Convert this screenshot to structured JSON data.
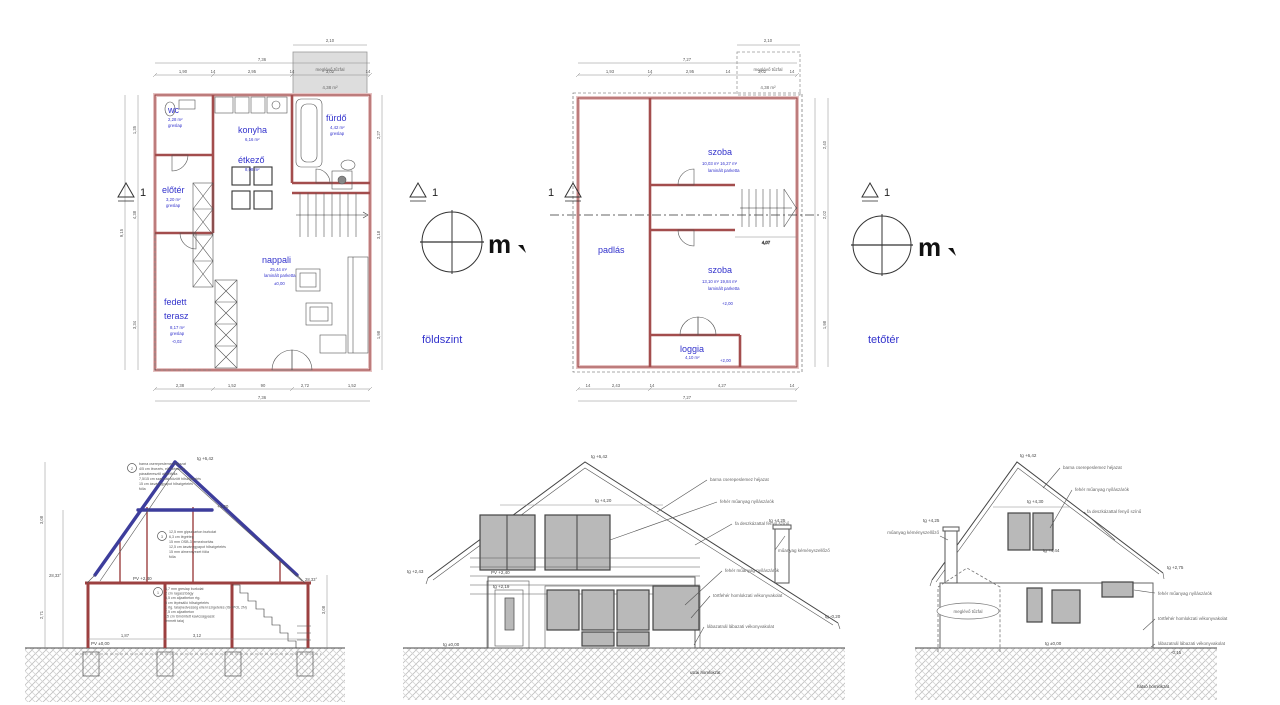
{
  "palette": {
    "wall_edge": "#9c4343",
    "wall_fill": "#e6c2c2",
    "label_blue": "#3232cc",
    "roof_blue": "#3d3d9c",
    "window_gray": "#b9b9b9",
    "ground_hatch": "#bfbfbf"
  },
  "gf": {
    "caption": "földszint",
    "marker": "1",
    "north": "m",
    "shed_label": "meglévő tűzfal",
    "shed_area": "4,38 m²",
    "shed_dim": "2,10",
    "rooms": {
      "wc": {
        "n": "wc",
        "a": "2,28 m²",
        "f": "greslap"
      },
      "konyha": {
        "n": "konyha",
        "a": "6,16 m²"
      },
      "etkezo": {
        "n": "étkező",
        "a": "8,08 m²"
      },
      "furdo": {
        "n": "fürdő",
        "a": "4,42 m²",
        "f": "greslap"
      },
      "eloter": {
        "n": "előtér",
        "a": "3,20 m²",
        "f": "greslap"
      },
      "nappali": {
        "n": "nappali",
        "a": "25,44 m²",
        "f": "laminált parketta",
        "lv": "±0,00"
      },
      "terasz": {
        "n": "fedett",
        "n2": "terasz",
        "a": "8,17 m²",
        "f": "greslap",
        "lv": "-0,02"
      }
    },
    "dim_top": [
      "1,90",
      "14",
      "2,95",
      "14",
      "3,02",
      "14"
    ],
    "dim_top_total": "7,36",
    "dim_bottom": [
      "2,38",
      "1,52",
      "90",
      "2,72",
      "1,52"
    ],
    "dim_bottom_total": "7,36",
    "dim_left": [
      "1,35",
      "4,38",
      "3,34"
    ],
    "dim_left_total": "9,15",
    "dim_right": [
      "2,27",
      "3,18",
      "1,98"
    ]
  },
  "at": {
    "caption": "tetőtér",
    "marker": "1",
    "north": "m",
    "shed_label": "meglévő tűzfal",
    "shed_area": "4,38 m²",
    "shed_dim": "2,10",
    "rooms": {
      "padlas": {
        "n": "padlás"
      },
      "szoba1": {
        "n": "szoba",
        "a": "10,03 m²   16,27 m²",
        "f": "laminált parketta"
      },
      "szoba2": {
        "n": "szoba",
        "a": "13,10 m²   19,84 m²",
        "f": "laminált parketta",
        "lv": "+2,00"
      },
      "loggia": {
        "n": "loggia",
        "a": "4,10 m²",
        "f": "greslap",
        "lv": "+2,00"
      }
    },
    "dim_top": [
      "1,93",
      "14",
      "2,95",
      "14",
      "3,02",
      "14"
    ],
    "dim_top_total": "7,27",
    "dim_bottom": [
      "14",
      "2,43",
      "14",
      "4,27",
      "14"
    ],
    "dim_bottom_total": "7,27",
    "dim_right": [
      "2,40",
      "2,02",
      "1,98"
    ],
    "stair_dim": "4,07"
  },
  "sec": {
    "peak": "tg +6,42",
    "angle_l": "28,33°",
    "angle_r": "28,33°",
    "lv_collar": "+4,20",
    "lv_attic": "PV +2,40",
    "lv_ground": "PV ±0,00",
    "n2_no": "2",
    "n3_no": "3",
    "n1_no": "1",
    "n2": [
      "barna cserepeslemez héjazat",
      "4/5 cm lécezés, ellenlécezés",
      "páraáteresztő alátétfólia",
      "7,5/15 cm szarufák között hőszigetelés",
      "15 cm ásványgyapot hőszigetelés",
      "fólia"
    ],
    "n3": [
      "12,5 mm gipszkarton burkolat",
      "6,3 cm légréteg",
      "15 mm OSB-3 lemezborítás",
      "12,5 cm ásványgyapot hőszigetelés",
      "15 mm álmennyezet fólia",
      "fólia"
    ],
    "n1": [
      "8,7 mm greslap burkolat",
      "2 cm ragasztóágy",
      "6,5 cm aljzatbeton rtg.",
      "5 cm lépésálló hőszigetelés",
      "1 rtg. talajnedvesség elleni szigetelés (ISOPOL 2N)",
      "7,5 cm aljzatbeton",
      "15 cm tömörített kavicságyazat",
      "termett talaj"
    ],
    "dim_left_up": "3,08",
    "dim_left_dn": "2,71",
    "dim_right": "3,08",
    "dim_b1": "1,87",
    "dim_b2": "3,12"
  },
  "fe": {
    "peak": "tg +6,42",
    "lv_gable": "tg +4,20",
    "lv_chimney": "tg +4,25",
    "lv_eave": "tg +2,43",
    "lv_balc": "PV +2,40",
    "lv_door": "tg +2,19",
    "lv_ground": "tg ±0,00",
    "lv_right": "tg -0,20",
    "labels": [
      "barna cserepeslemez héjazat",
      "fehér műanyag nyílászárók",
      "fa deszkázattal fenyő színű",
      "műanyag kéményszellőző",
      "fehér műanyag nyílászárók",
      "törtfehér homlokzati vékonyvakolat",
      "lábazatnál lábazati vékonyvakolat"
    ],
    "caption": "utcai homlokzat"
  },
  "se": {
    "peak": "tg +6,42",
    "lv_gable": "tg +4,30",
    "lv_chimney": "tg +4,25",
    "lv_mid": "tg +4,44",
    "lv_eave_r": "tg +2,75",
    "lv_ground": "tg ±0,00",
    "lv_base": "-0,15",
    "label_l": "műanyag kéményszellőző",
    "labels": [
      "barna cserepeslemez héjazat",
      "fehér műanyag nyílászárók",
      "fa deszkázattal fenyő színű",
      "fehér műanyag nyílászárók",
      "törtfehér homlokzati vékonyvakolat",
      "lábazatnál lábazati vékonyvakolat"
    ],
    "shed": "meglévő tűzfal",
    "caption": "hátsó homlokzat"
  }
}
